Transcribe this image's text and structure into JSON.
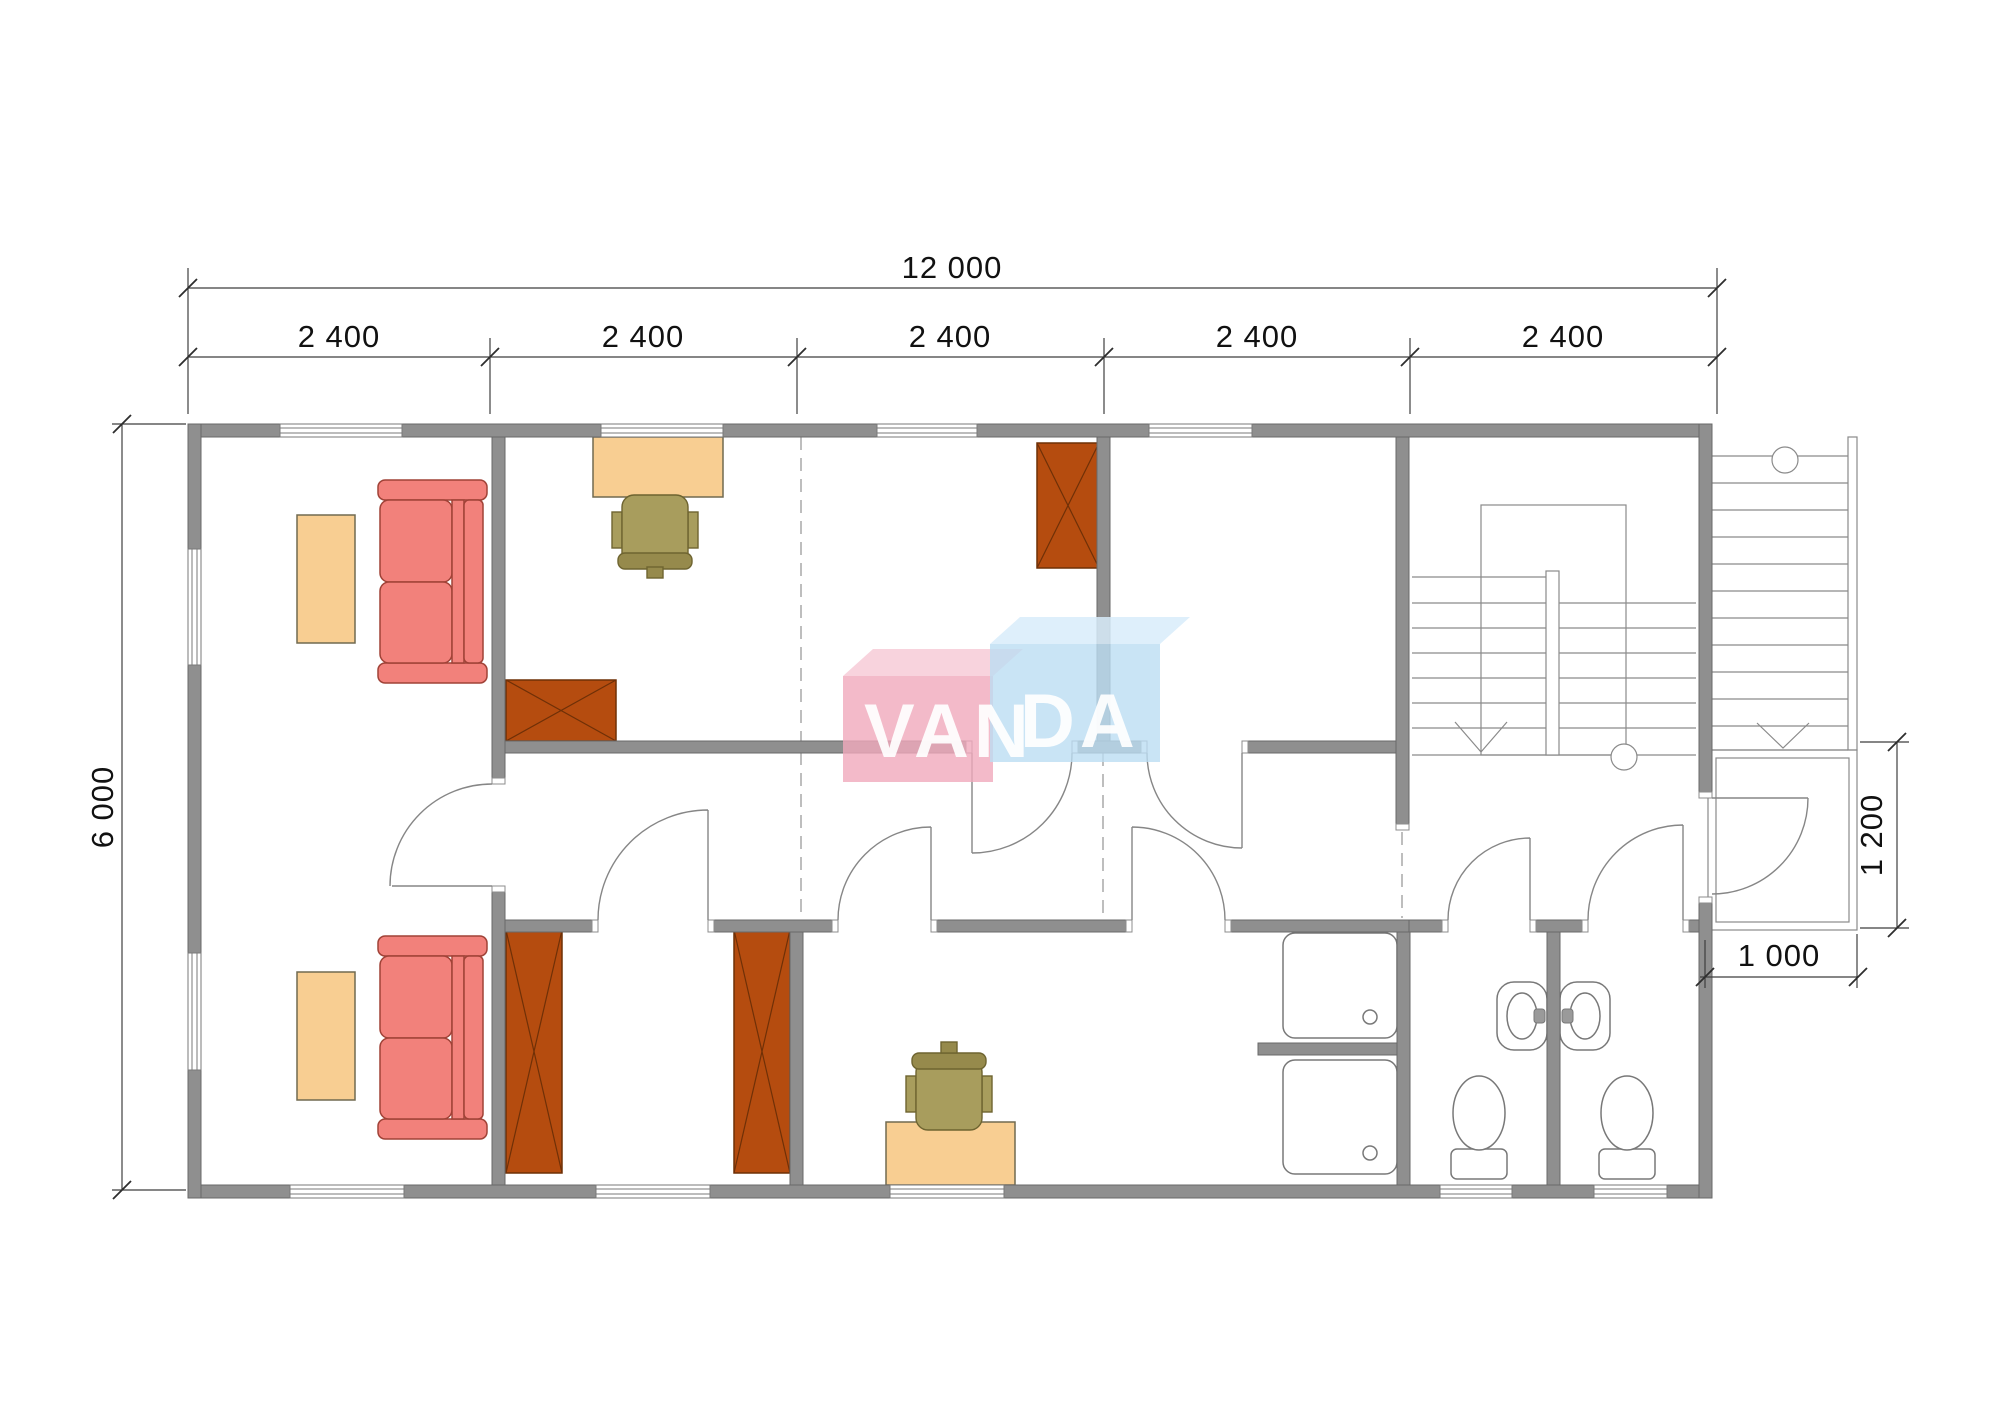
{
  "watermark": {
    "part1": "VAN",
    "part2": "DA",
    "full": "VANDA"
  },
  "dimensions": {
    "overall_width": "12 000",
    "bay_labels": [
      "2 400",
      "2 400",
      "2 400",
      "2 400",
      "2 400"
    ],
    "overall_depth": "6 000",
    "porch_depth": "1 200",
    "porch_width": "1 000"
  },
  "colors": {
    "wall": "#8F8F8F",
    "wall_edge": "#696969",
    "sofa": "#F2817B",
    "sofa_edge": "#A04237",
    "table": "#F8CE92",
    "wardrobe": "#B54C0F",
    "chair": "#A89D5D",
    "logo_pink": "#F0A9BC",
    "logo_blue": "#BBDDF3",
    "dimension_text": "#111111"
  }
}
